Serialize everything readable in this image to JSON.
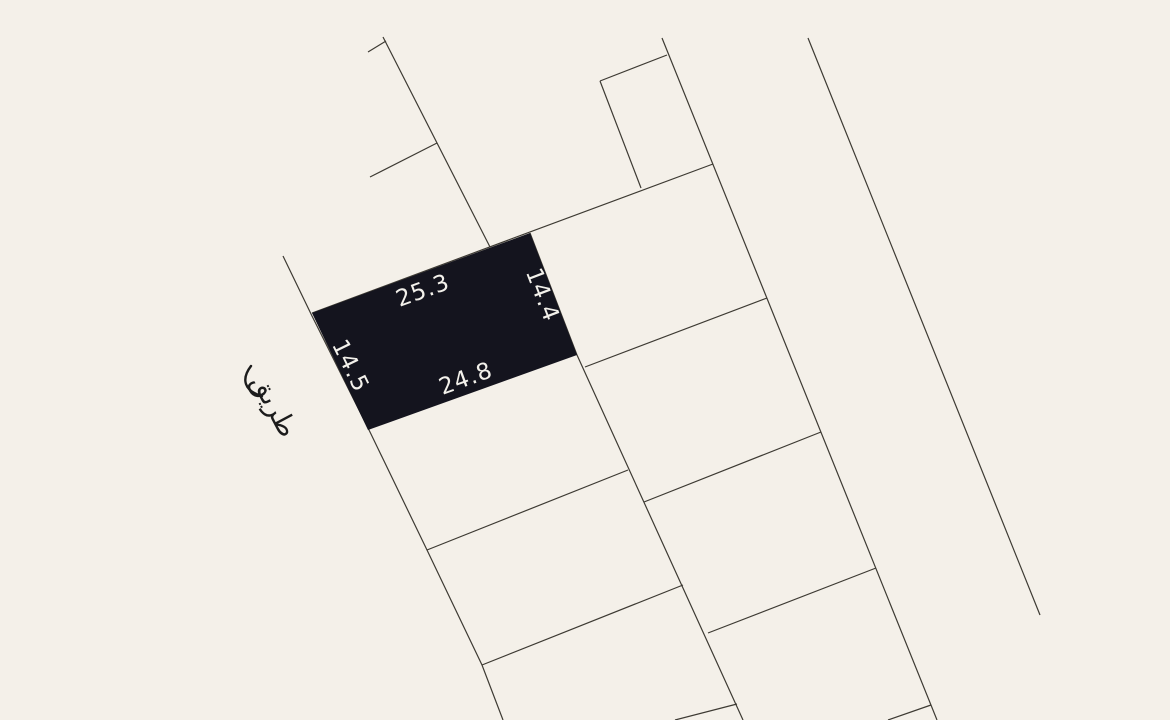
{
  "canvas": {
    "width": 1170,
    "height": 720,
    "background_color": "#f4f0e9",
    "line_color": "#3d3a33",
    "line_width": 1.2
  },
  "plot": {
    "fill_color": "#14141e",
    "label_color": "#f3f1eb",
    "polygon": [
      [
        312,
        313
      ],
      [
        530,
        233
      ],
      [
        577,
        355
      ],
      [
        368,
        430
      ]
    ],
    "dimensions": {
      "top": "25.3",
      "right": "14.4",
      "bottom": "24.8",
      "left": "14.5"
    }
  },
  "road": {
    "label": "طريق",
    "text_color": "#1c1c1c"
  },
  "parcel_lines": [
    {
      "name": "west-boundary-line",
      "points": [
        [
          283,
          256
        ],
        [
          312,
          316
        ],
        [
          370,
          432
        ],
        [
          427,
          550
        ],
        [
          482,
          665
        ],
        [
          503,
          720
        ]
      ]
    },
    {
      "name": "upper-left-line",
      "points": [
        [
          383,
          37
        ],
        [
          490,
          247
        ]
      ]
    },
    {
      "name": "upper-tick-1",
      "points": [
        [
          368,
          52
        ],
        [
          386,
          41
        ]
      ]
    },
    {
      "name": "upper-tick-2",
      "points": [
        [
          370,
          177
        ],
        [
          437,
          143
        ]
      ]
    },
    {
      "name": "block-top-line",
      "points": [
        [
          312,
          313
        ],
        [
          713,
          164
        ]
      ]
    },
    {
      "name": "small-parcel-top-edge",
      "points": [
        [
          600,
          81
        ],
        [
          667,
          55
        ]
      ]
    },
    {
      "name": "small-parcel-left-edge",
      "points": [
        [
          600,
          81
        ],
        [
          641,
          188
        ]
      ]
    },
    {
      "name": "middle-column-east-line",
      "points": [
        [
          530,
          233
        ],
        [
          577,
          355
        ],
        [
          743,
          720
        ]
      ]
    },
    {
      "name": "east-boundary-line",
      "points": [
        [
          662,
          38
        ],
        [
          937,
          720
        ]
      ]
    },
    {
      "name": "middle-divider-1",
      "points": [
        [
          427,
          550
        ],
        [
          628,
          470
        ]
      ]
    },
    {
      "name": "middle-divider-2",
      "points": [
        [
          482,
          665
        ],
        [
          683,
          585
        ]
      ]
    },
    {
      "name": "middle-divider-3",
      "points": [
        [
          675,
          720
        ],
        [
          737,
          704
        ]
      ]
    },
    {
      "name": "right-divider-1",
      "points": [
        [
          585,
          367
        ],
        [
          767,
          298
        ]
      ]
    },
    {
      "name": "right-divider-2",
      "points": [
        [
          644,
          502
        ],
        [
          821,
          432
        ]
      ]
    },
    {
      "name": "right-divider-3",
      "points": [
        [
          708,
          633
        ],
        [
          876,
          568
        ]
      ]
    },
    {
      "name": "right-divider-4",
      "points": [
        [
          888,
          720
        ],
        [
          931,
          705
        ]
      ]
    },
    {
      "name": "far-right-road-line",
      "points": [
        [
          808,
          38
        ],
        [
          1040,
          615
        ]
      ]
    }
  ]
}
